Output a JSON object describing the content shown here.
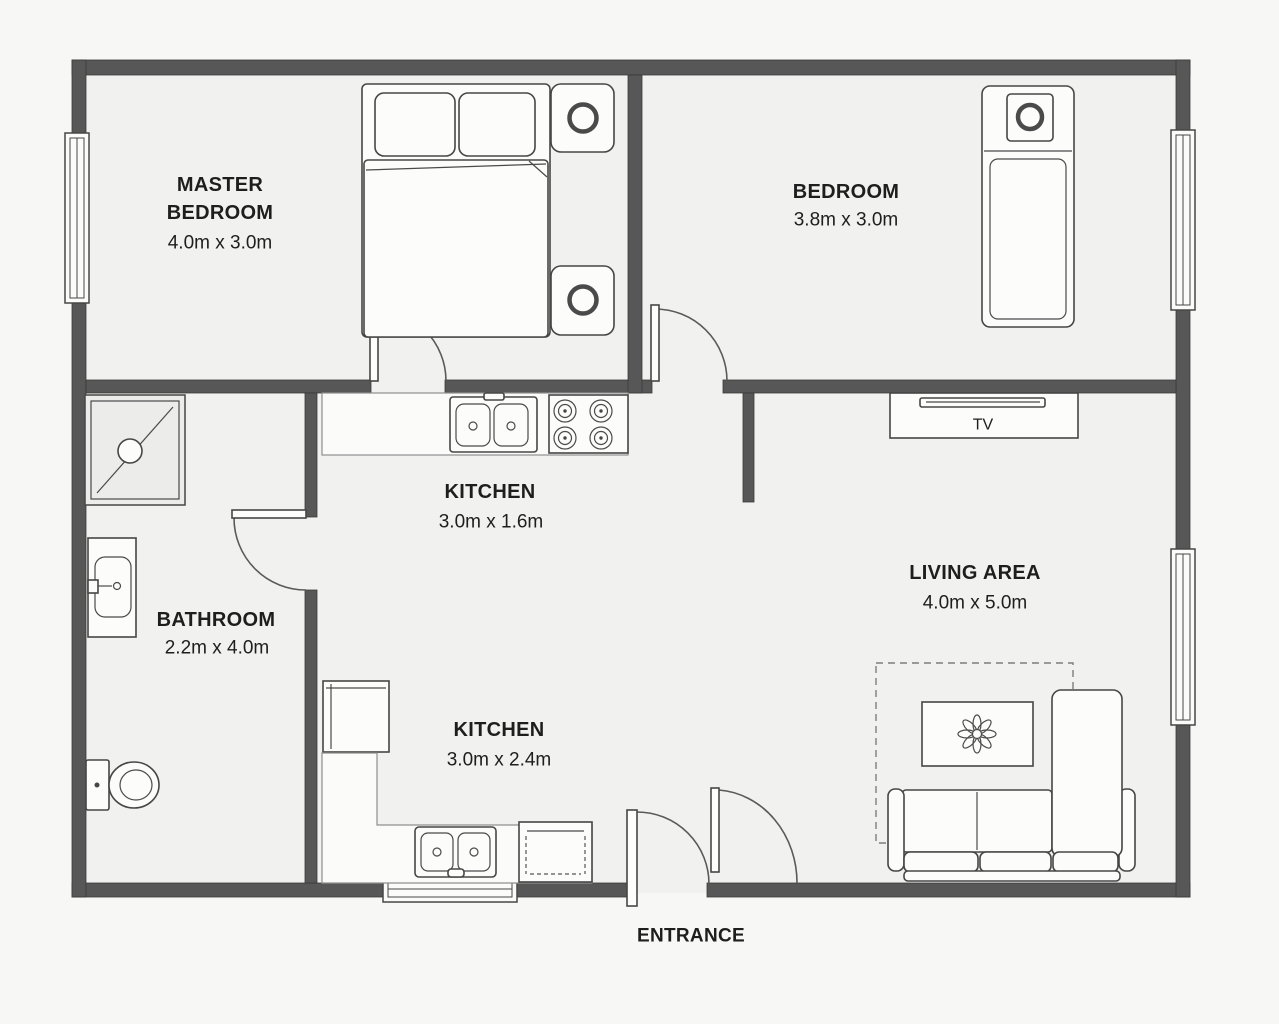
{
  "rooms": [
    {
      "id": "master-bedroom",
      "lines": [
        "MASTER",
        "BEDROOM"
      ],
      "dims": "4.0m x 3.0m"
    },
    {
      "id": "bedroom",
      "lines": [
        "BEDROOM"
      ],
      "dims": "3.8m x 3.0m"
    },
    {
      "id": "kitchen-upper",
      "lines": [
        "KITCHEN"
      ],
      "dims": "3.0m x 1.6m"
    },
    {
      "id": "bathroom",
      "lines": [
        "BATHROOM"
      ],
      "dims": "2.2m x 4.0m"
    },
    {
      "id": "kitchen-lower",
      "lines": [
        "KITCHEN"
      ],
      "dims": "3.0m x 2.4m"
    },
    {
      "id": "living-area",
      "lines": [
        "LIVING AREA"
      ],
      "dims": "4.0m x 5.0m"
    }
  ],
  "annotations": {
    "tv": "TV",
    "entrance": "ENTRANCE"
  },
  "colors": {
    "wall": "#575757",
    "floor": "#f1f1ef",
    "outside": "#f7f7f5",
    "line": "#464646"
  }
}
